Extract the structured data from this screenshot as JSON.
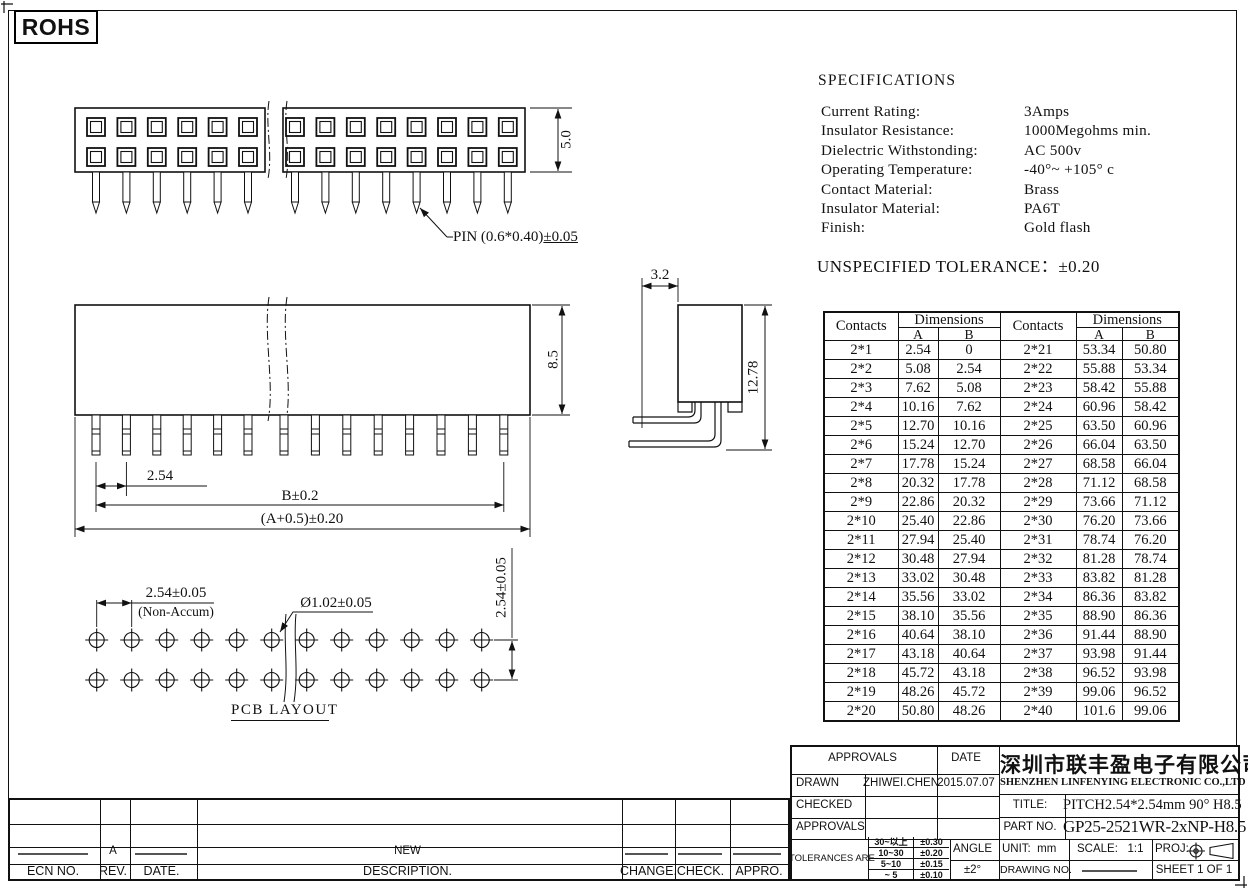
{
  "page": {
    "rohs": "ROHS"
  },
  "drawing_labels": {
    "pin_spec_main": "PIN (0.6*0.40)",
    "pin_spec_tol": "±0.05",
    "top_height": "5.0",
    "front_height": "8.5",
    "front_pitch": "2.54",
    "front_span_b": "B±0.2",
    "front_span_a": "(A+0.5)±0.20",
    "side_width": "3.2",
    "side_height": "12.78",
    "pcb_pitch": "2.54±0.05",
    "pcb_pitch_note": "(Non-Accum)",
    "pcb_hole": "Ø1.02±0.05",
    "pcb_row_pitch": "2.54±0.05",
    "pcb_caption": "PCB LAYOUT"
  },
  "specifications": {
    "title": "SPECIFICATIONS",
    "items": [
      {
        "label": "Current Rating:",
        "value": "3Amps"
      },
      {
        "label": "Insulator Resistance:",
        "value": "1000Megohms min."
      },
      {
        "label": "Dielectric Withstonding:",
        "value": "AC 500v"
      },
      {
        "label": "Operating Temperature:",
        "value": "-40°~ +105° c"
      },
      {
        "label": "Contact Material:",
        "value": "Brass"
      },
      {
        "label": "Insulator Material:",
        "value": "PA6T"
      },
      {
        "label": "Finish:",
        "value": "Gold  flash"
      }
    ],
    "tolerance_note_label": "UNSPECIFIED TOLERANCE：",
    "tolerance_note_value": "±0.20"
  },
  "dim_table": {
    "contacts_header": "Contacts",
    "dimensions_header": "Dimensions",
    "col_a": "A",
    "col_b": "B",
    "rows": [
      [
        "2*1",
        "2.54",
        "0",
        "2*21",
        "53.34",
        "50.80"
      ],
      [
        "2*2",
        "5.08",
        "2.54",
        "2*22",
        "55.88",
        "53.34"
      ],
      [
        "2*3",
        "7.62",
        "5.08",
        "2*23",
        "58.42",
        "55.88"
      ],
      [
        "2*4",
        "10.16",
        "7.62",
        "2*24",
        "60.96",
        "58.42"
      ],
      [
        "2*5",
        "12.70",
        "10.16",
        "2*25",
        "63.50",
        "60.96"
      ],
      [
        "2*6",
        "15.24",
        "12.70",
        "2*26",
        "66.04",
        "63.50"
      ],
      [
        "2*7",
        "17.78",
        "15.24",
        "2*27",
        "68.58",
        "66.04"
      ],
      [
        "2*8",
        "20.32",
        "17.78",
        "2*28",
        "71.12",
        "68.58"
      ],
      [
        "2*9",
        "22.86",
        "20.32",
        "2*29",
        "73.66",
        "71.12"
      ],
      [
        "2*10",
        "25.40",
        "22.86",
        "2*30",
        "76.20",
        "73.66"
      ],
      [
        "2*11",
        "27.94",
        "25.40",
        "2*31",
        "78.74",
        "76.20"
      ],
      [
        "2*12",
        "30.48",
        "27.94",
        "2*32",
        "81.28",
        "78.74"
      ],
      [
        "2*13",
        "33.02",
        "30.48",
        "2*33",
        "83.82",
        "81.28"
      ],
      [
        "2*14",
        "35.56",
        "33.02",
        "2*34",
        "86.36",
        "83.82"
      ],
      [
        "2*15",
        "38.10",
        "35.56",
        "2*35",
        "88.90",
        "86.36"
      ],
      [
        "2*16",
        "40.64",
        "38.10",
        "2*36",
        "91.44",
        "88.90"
      ],
      [
        "2*17",
        "43.18",
        "40.64",
        "2*37",
        "93.98",
        "91.44"
      ],
      [
        "2*18",
        "45.72",
        "43.18",
        "2*38",
        "96.52",
        "93.98"
      ],
      [
        "2*19",
        "48.26",
        "45.72",
        "2*39",
        "99.06",
        "96.52"
      ],
      [
        "2*20",
        "50.80",
        "48.26",
        "2*40",
        "101.6",
        "99.06"
      ]
    ]
  },
  "title_block": {
    "approvals_header": "APPROVALS",
    "date_header": "DATE",
    "drawn_label": "DRAWN",
    "drawn_name": "ZHIWEI.CHEN",
    "drawn_date": "2015.07.07",
    "checked_label": "CHECKED",
    "approvals_label": "APPROVALS",
    "tolerances_label": "TOLERANCES ARE",
    "tolerances": [
      {
        "range": "30~以上",
        "tol": "±0.30"
      },
      {
        "range": "10~30",
        "tol": "±0.20"
      },
      {
        "range": "5~10",
        "tol": "±0.15"
      },
      {
        "range": "~ 5",
        "tol": "±0.10"
      }
    ],
    "angle_label": "ANGLE",
    "angle_tol": "±2°",
    "company_cn": "深圳市联丰盈电子有限公司",
    "company_en": "SHENZHEN LINFENYING ELECTRONIC CO.,LTD",
    "title_label": "TITLE:",
    "title_value": "PITCH2.54*2.54mm 90° H8.5",
    "part_label": "PART NO.",
    "part_value": "GP25-2521WR-2xNP-H8.5",
    "unit_label": "UNIT:",
    "unit_value": "mm",
    "scale_label": "SCALE:",
    "scale_value": "1:1",
    "proj_label": "PROJ:",
    "drawing_no_label": "DRAWING NO.",
    "sheet_label": "SHEET  1 OF 1"
  },
  "revision_table": {
    "headers": [
      "ECN  NO.",
      "REV.",
      "DATE.",
      "DESCRIPTION.",
      "CHANGE.",
      "CHECK.",
      "APPRO."
    ],
    "entry": {
      "rev": "A",
      "description": "NEW"
    }
  }
}
